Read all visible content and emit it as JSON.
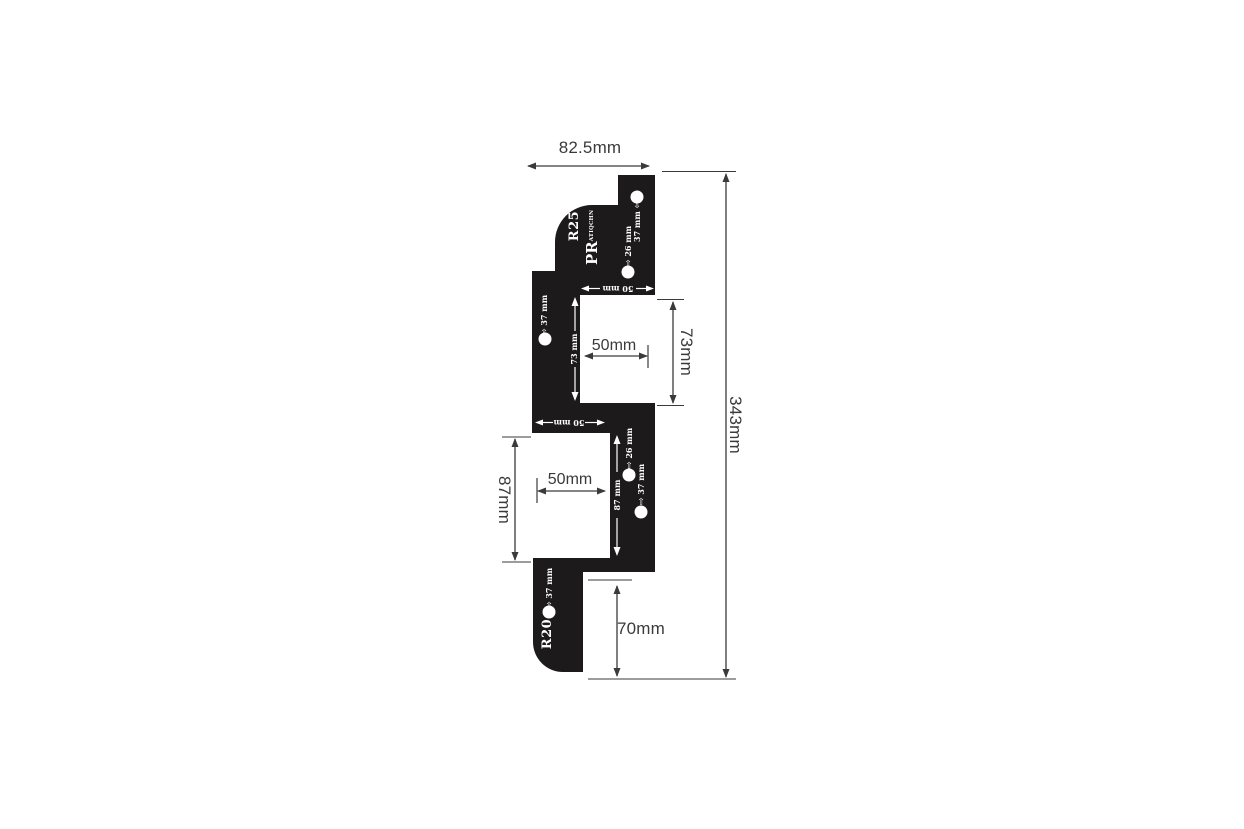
{
  "canvas": {
    "background": "#ffffff",
    "ink_color": "#3a3a3a",
    "template_fill": "#1c1a1b"
  },
  "dimensions": {
    "top_width": "82.5mm",
    "overall_height": "343mm",
    "upper_notch_height": "73mm",
    "upper_notch_width": "50mm",
    "lower_notch_height": "87mm",
    "lower_notch_width": "50mm",
    "bottom_offset": "70mm"
  },
  "template": {
    "radius_upper": "R25",
    "radius_lower": "R20",
    "brand": "PR",
    "brand_small": "ATIQCHN",
    "slot_upper": "73 mm",
    "slot_lower": "87 mm",
    "edge_upper": "50 mm",
    "edge_lower": "50 mm",
    "offset_37_top": "37 mm",
    "offset_26_top": "26 mm",
    "offset_37_mid": "37 mm",
    "offset_26_low": "26 mm",
    "offset_37_low": "37 mm",
    "offset_37_bottom": "37 mm",
    "arrow_left": "⇦",
    "arrow_right": "⇨"
  }
}
